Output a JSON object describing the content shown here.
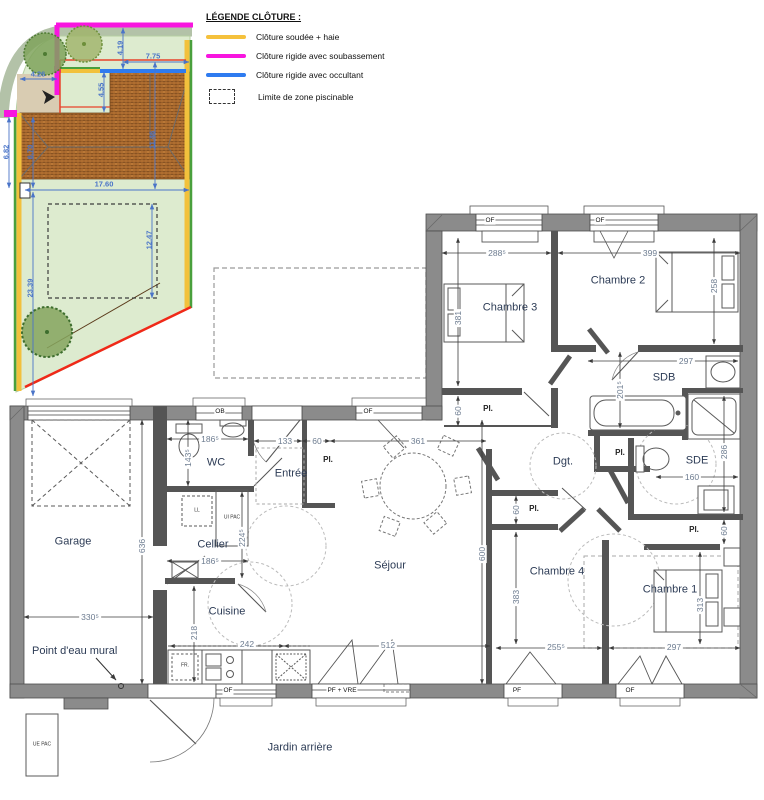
{
  "legend": {
    "title": "LÉGENDE CLÔTURE :",
    "items": [
      {
        "label": "Clôture soudée + haie",
        "color": "#F5C13C"
      },
      {
        "label": "Clôture rigide avec soubassement",
        "color": "#F815DF"
      },
      {
        "label": "Clôture rigide avec occultant",
        "color": "#2E7BF0"
      },
      {
        "label": "Limite de zone piscinable",
        "color": "dashed"
      }
    ]
  },
  "site": {
    "dims": {
      "d1": "4.26",
      "d2": "4.19",
      "d3": "7.75",
      "d4": "4.55",
      "d5": "11.46",
      "d6": "6.82",
      "d7": "6.70",
      "d8": "17.60",
      "d9": "12.47",
      "d10": "23.39"
    }
  },
  "plan": {
    "rooms": {
      "garage": "Garage",
      "wc": "WC",
      "entree": "Entrée",
      "cellier": "Cellier",
      "cuisine": "Cuisine",
      "sejour": "Séjour",
      "ch1": "Chambre 1",
      "ch2": "Chambre 2",
      "ch3": "Chambre 3",
      "ch4": "Chambre 4",
      "sdb": "SDB",
      "sde": "SDE",
      "dgt": "Dgt.",
      "point_eau": "Point d'eau mural",
      "jardin": "Jardin arrière"
    },
    "dims": {
      "w288": "288⁵",
      "w399": "399",
      "h381": "381",
      "h258": "258",
      "w297": "297",
      "h201": "201⁵",
      "h286": "286",
      "w160": "160",
      "w133": "133",
      "d60": "60",
      "w361": "361",
      "h600": "600",
      "h636": "636",
      "w186": "186⁵",
      "h143": "143⁵",
      "h224": "224⁵",
      "w330": "330⁵",
      "h218": "218",
      "w242": "242",
      "w512": "512",
      "w255": "255⁵",
      "h383": "383",
      "h313": "313"
    },
    "windows": {
      "of": "OF",
      "ob": "OB",
      "pf": "PF",
      "pf_vre": "PF + VRE"
    },
    "labels": {
      "pl": "Pl.",
      "ll": "LL",
      "ui_pac": "UI PAC",
      "ue_pac": "UE PAC",
      "fr": "FR."
    }
  }
}
